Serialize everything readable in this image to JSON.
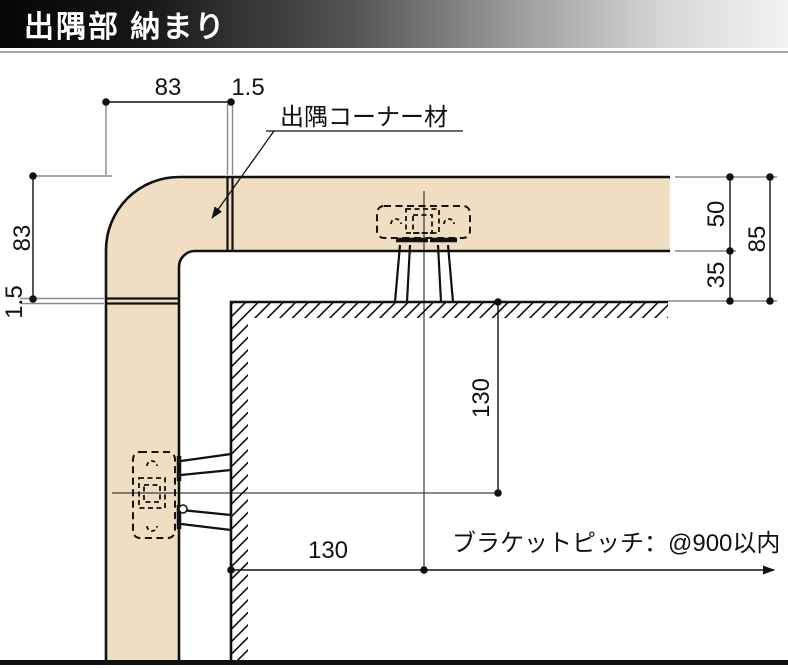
{
  "header": {
    "title": "出隅部 納まり"
  },
  "annotations": {
    "corner_material": "出隅コーナー材",
    "bracket_pitch": "ブラケットピッチ：@900以内"
  },
  "dimensions": {
    "top_width": "83",
    "top_joint_gap": "1.5",
    "left_height": "83",
    "left_joint_gap": "1.5",
    "rail_depth": "50",
    "wall_clearance": "35",
    "overall_depth": "85",
    "bracket_offset_down": "130",
    "bracket_offset_side": "130"
  },
  "colors": {
    "rail_fill": "#F0DEC2",
    "line": "#111111",
    "header_text": "#FFFFFF"
  }
}
